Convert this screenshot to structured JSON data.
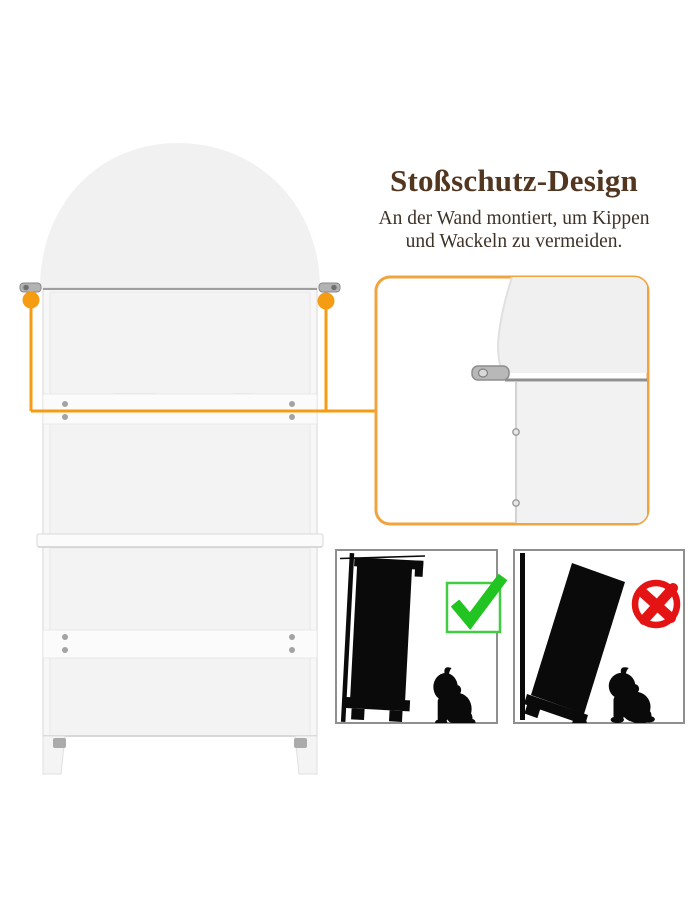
{
  "header": {
    "title": "Stoßschutz-Design",
    "subtitle_line1": "An der Wand montiert, um Kippen",
    "subtitle_line2": "und Wackeln zu vermeiden."
  },
  "icons": {
    "allowed": "green-checkmark-icon",
    "forbidden": "red-cross-circle-icon"
  },
  "colors": {
    "accent_orange": "#F59C12",
    "callout_border": "#F0A440",
    "title_brown": "#523620",
    "subtitle_brown": "#3D3228",
    "check_green": "#21C421",
    "check_green_border": "#41CC41",
    "cross_red": "#E41414",
    "frame_gray": "#8F8F8F",
    "silhouette_black": "#0A0A0A",
    "shelf_line_gray": "#9E9E9E"
  }
}
